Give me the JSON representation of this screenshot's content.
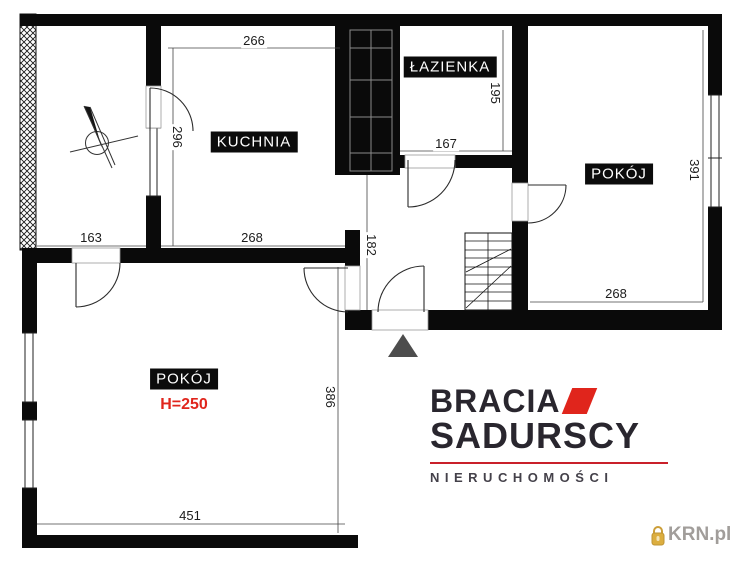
{
  "plan": {
    "room_labels": {
      "kitchen": "KUCHNIA",
      "bathroom": "ŁAZIENKA",
      "room_right": "POKÓJ",
      "room_left": "POKÓJ",
      "room_left_height": "H=250"
    },
    "dimensions": {
      "kitchen_top": "266",
      "kitchen_left": "296",
      "kitchen_bottom": "268",
      "loggia_bottom": "163",
      "bathroom_bottom": "167",
      "bathroom_right": "195",
      "hall": "182",
      "room_right_side": "391",
      "room_right_bottom": "268",
      "room_left_side": "386",
      "room_left_bottom": "451"
    },
    "symbols": {
      "entrance_marker": "gray-triangle",
      "north_indicator": "compass-needle",
      "stairs": "staircase"
    }
  },
  "branding": {
    "line1": "BRACIA",
    "line2": "SADURSCY",
    "line3": "NIERUCHOMOŚCI",
    "mark": "red-parallelogram"
  },
  "watermark": {
    "text": "KRN.pl",
    "icon": "gold-padlock-icon"
  },
  "colors": {
    "wall": "#0a0a0a",
    "accent_red": "#e0251c",
    "logo_dark": "#29262e",
    "logo_rule_red": "#c9202a",
    "watermark_gray": "#979390",
    "watermark_gold": "#d9a62b",
    "triangle_gray": "#4d4d4d"
  }
}
